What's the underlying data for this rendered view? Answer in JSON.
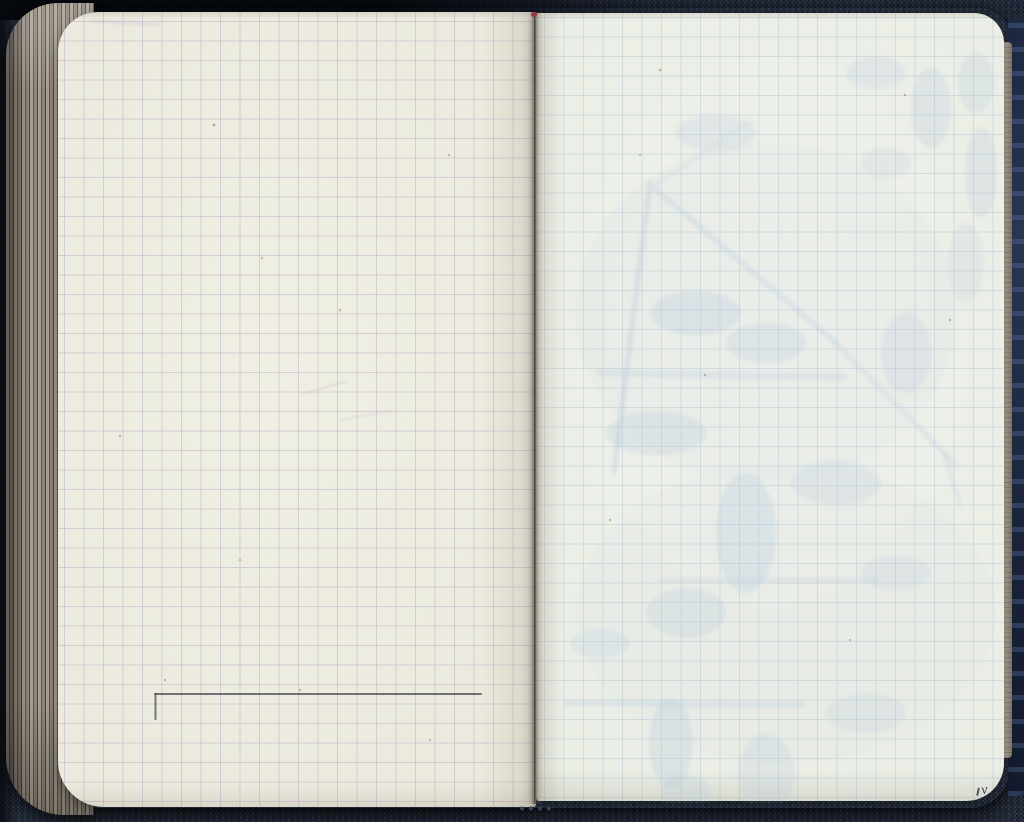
{
  "scene": {
    "subject": "open squared-paper pocket notebook on dark navy fabric",
    "left_page_content": "blank grid page with a single hand-ruled horizontal pencil line near the bottom",
    "right_page_content": "blank grid page with faint blue show-through of sketches and notes from the reverse side"
  },
  "marks": {
    "corner_mark": "v",
    "pencil_lines": [
      {
        "x1": 97,
        "y1": 682,
        "x2": 423,
        "y2": 682,
        "w": 1.8,
        "o": 0.85
      },
      {
        "x1": 97.5,
        "y1": 682,
        "x2": 97.5,
        "y2": 707,
        "w": 2.2,
        "o": 0.65
      }
    ]
  },
  "left_ghost_lines": [
    {
      "x1": 35,
      "y1": 9,
      "x2": 100,
      "y2": 13,
      "w": 4,
      "o": 0.16,
      "c": "#b0a0c5"
    },
    {
      "x1": 243,
      "y1": 383,
      "x2": 288,
      "y2": 369,
      "w": 1,
      "o": 0.3,
      "c": "#8a8a95"
    },
    {
      "x1": 282,
      "y1": 408,
      "x2": 335,
      "y2": 398,
      "w": 1,
      "o": 0.22,
      "c": "#8a8a95"
    }
  ],
  "right_ghost": {
    "lines": [
      {
        "x1": 114,
        "y1": 170,
        "x2": 78,
        "y2": 458,
        "w": 5,
        "o": 0.38
      },
      {
        "x1": 118,
        "y1": 175,
        "x2": 300,
        "y2": 330,
        "w": 5,
        "o": 0.34
      },
      {
        "x1": 300,
        "y1": 330,
        "x2": 420,
        "y2": 452,
        "w": 5,
        "o": 0.28
      },
      {
        "x1": 119,
        "y1": 172,
        "x2": 215,
        "y2": 108,
        "w": 4,
        "o": 0.18
      },
      {
        "x1": 64,
        "y1": 360,
        "x2": 308,
        "y2": 364,
        "w": 7,
        "o": 0.28
      },
      {
        "x1": 124,
        "y1": 567,
        "x2": 340,
        "y2": 567,
        "w": 5,
        "o": 0.26
      },
      {
        "x1": 31,
        "y1": 690,
        "x2": 267,
        "y2": 692,
        "w": 6,
        "o": 0.3
      },
      {
        "x1": 408,
        "y1": 440,
        "x2": 424,
        "y2": 492,
        "w": 5,
        "o": 0.22
      }
    ],
    "patches": [
      {
        "cx": 230,
        "cy": 300,
        "rx": 190,
        "ry": 170,
        "o": 0.07
      },
      {
        "cx": 250,
        "cy": 600,
        "rx": 210,
        "ry": 150,
        "o": 0.06
      },
      {
        "cx": 180,
        "cy": 120,
        "rx": 40,
        "ry": 18,
        "o": 0.22
      },
      {
        "cx": 340,
        "cy": 60,
        "rx": 30,
        "ry": 16,
        "o": 0.22
      },
      {
        "cx": 395,
        "cy": 95,
        "rx": 20,
        "ry": 40,
        "o": 0.26
      },
      {
        "cx": 440,
        "cy": 70,
        "rx": 18,
        "ry": 30,
        "o": 0.26
      },
      {
        "cx": 350,
        "cy": 150,
        "rx": 25,
        "ry": 15,
        "o": 0.2
      },
      {
        "cx": 445,
        "cy": 160,
        "rx": 16,
        "ry": 45,
        "o": 0.26
      },
      {
        "cx": 430,
        "cy": 250,
        "rx": 18,
        "ry": 40,
        "o": 0.2
      },
      {
        "cx": 160,
        "cy": 300,
        "rx": 45,
        "ry": 22,
        "o": 0.3
      },
      {
        "cx": 230,
        "cy": 330,
        "rx": 40,
        "ry": 20,
        "o": 0.26
      },
      {
        "cx": 120,
        "cy": 420,
        "rx": 50,
        "ry": 22,
        "o": 0.28
      },
      {
        "cx": 370,
        "cy": 340,
        "rx": 25,
        "ry": 40,
        "o": 0.22
      },
      {
        "cx": 210,
        "cy": 520,
        "rx": 30,
        "ry": 60,
        "o": 0.3
      },
      {
        "cx": 150,
        "cy": 600,
        "rx": 40,
        "ry": 25,
        "o": 0.26
      },
      {
        "cx": 300,
        "cy": 470,
        "rx": 45,
        "ry": 22,
        "o": 0.24
      },
      {
        "cx": 360,
        "cy": 560,
        "rx": 35,
        "ry": 18,
        "o": 0.2
      },
      {
        "cx": 64,
        "cy": 630,
        "rx": 30,
        "ry": 15,
        "o": 0.22
      },
      {
        "cx": 135,
        "cy": 730,
        "rx": 22,
        "ry": 45,
        "o": 0.3
      },
      {
        "cx": 150,
        "cy": 780,
        "rx": 25,
        "ry": 18,
        "o": 0.26
      },
      {
        "cx": 230,
        "cy": 760,
        "rx": 28,
        "ry": 40,
        "o": 0.24
      },
      {
        "cx": 330,
        "cy": 700,
        "rx": 40,
        "ry": 20,
        "o": 0.2
      }
    ]
  },
  "speckles": [
    {
      "x": 214,
      "y": 125,
      "r": 1.4,
      "c": "#8a6f52"
    },
    {
      "x": 262,
      "y": 258,
      "r": 1.2,
      "c": "#9b8a6d"
    },
    {
      "x": 449,
      "y": 155,
      "r": 1.0,
      "c": "#6b6a66"
    },
    {
      "x": 340,
      "y": 310,
      "r": 1.3,
      "c": "#b08968"
    },
    {
      "x": 120,
      "y": 436,
      "r": 1.1,
      "c": "#8a6f52"
    },
    {
      "x": 300,
      "y": 690,
      "r": 1.2,
      "c": "#9b8a6d"
    },
    {
      "x": 430,
      "y": 740,
      "r": 1.0,
      "c": "#6b6a66"
    },
    {
      "x": 660,
      "y": 70,
      "r": 1.3,
      "c": "#8f8a3f"
    },
    {
      "x": 905,
      "y": 95,
      "r": 1.1,
      "c": "#8a6f52"
    },
    {
      "x": 705,
      "y": 375,
      "r": 1.2,
      "c": "#9b8a6d"
    },
    {
      "x": 850,
      "y": 640,
      "r": 1.0,
      "c": "#8a6f52"
    },
    {
      "x": 950,
      "y": 320,
      "r": 1.1,
      "c": "#6b6a66"
    },
    {
      "x": 610,
      "y": 520,
      "r": 1.2,
      "c": "#9b8a6d"
    },
    {
      "x": 240,
      "y": 560,
      "r": 1.0,
      "c": "#8a6f52"
    },
    {
      "x": 640,
      "y": 155,
      "r": 1.0,
      "c": "#7b7668"
    },
    {
      "x": 165,
      "y": 680,
      "r": 1.0,
      "c": "#6b6a66"
    }
  ],
  "colors": {
    "fabric": "#2b3444",
    "pageLeft": "#f0efe4",
    "pageLeftEdge": "#ddd9c9",
    "pageRight": "#eff1ea",
    "gridLeft": "#9c90bc55",
    "gridRight": "#8fa6c845",
    "stackLight": "#a79e91",
    "stackMid": "#8d8478",
    "stackDark": "#5e584e",
    "pencil": "#45474b",
    "ghostInk": "#b7c9de",
    "spineLine": "#4c4a41",
    "spineDot": "#9a3943",
    "markInk": "#2c2f36"
  }
}
